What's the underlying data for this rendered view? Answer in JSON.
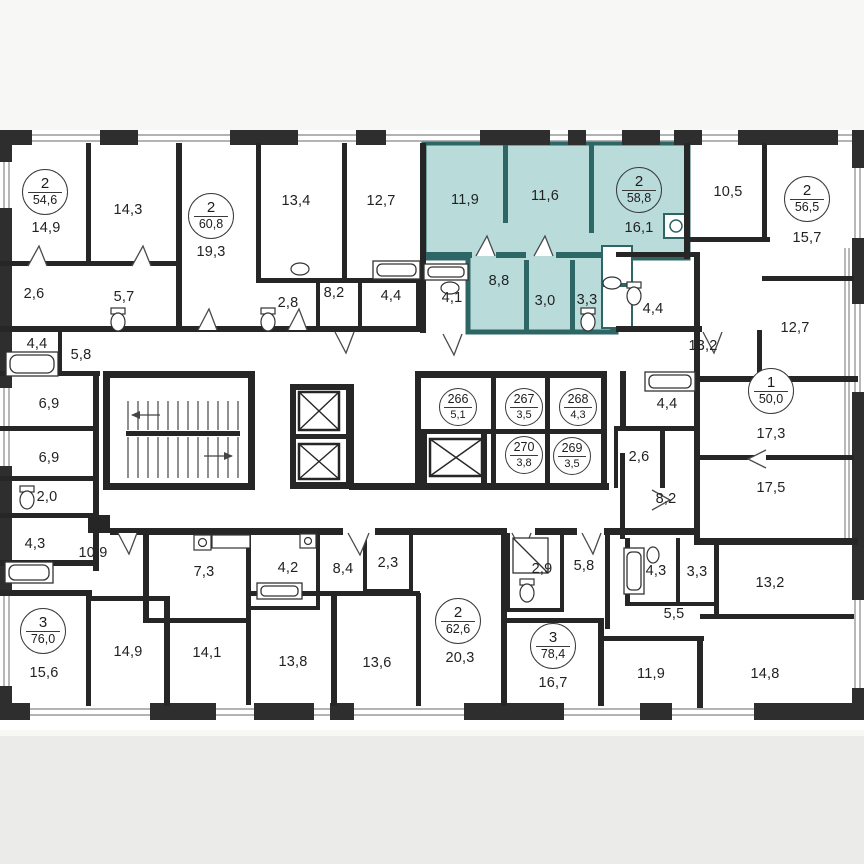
{
  "plan": {
    "type": "residential-floor-plan",
    "wall_color": "#262626",
    "highlight_color": "#b9dcda",
    "highlight_wall_color": "#2d6665",
    "highlighted_apartment": {
      "num": "2",
      "area": "58,8"
    },
    "apartments": [
      {
        "num": "2",
        "area": "54,6"
      },
      {
        "num": "2",
        "area": "60,8"
      },
      {
        "num": "2",
        "area": "58,8"
      },
      {
        "num": "2",
        "area": "56,5"
      },
      {
        "num": "1",
        "area": "50,0"
      },
      {
        "num": "3",
        "area": "76,0"
      },
      {
        "num": "2",
        "area": "62,6"
      },
      {
        "num": "3",
        "area": "78,4"
      }
    ],
    "units": [
      {
        "num": "266",
        "area": "5,1"
      },
      {
        "num": "267",
        "area": "3,5"
      },
      {
        "num": "268",
        "area": "4,3"
      },
      {
        "num": "270",
        "area": "3,8"
      },
      {
        "num": "269",
        "area": "3,5"
      }
    ],
    "rooms": [
      "14,9",
      "14,3",
      "19,3",
      "13,4",
      "12,7",
      "11,9",
      "11,6",
      "16,1",
      "10,5",
      "15,7",
      "2,6",
      "5,7",
      "4,4",
      "5,8",
      "2,8",
      "8,2",
      "4,4",
      "4,1",
      "8,8",
      "3,0",
      "3,3",
      "4,4",
      "13,2",
      "12,7",
      "6,9",
      "6,9",
      "2,0",
      "4,3",
      "10,9",
      "4,4",
      "17,3",
      "2,6",
      "17,5",
      "8,2",
      "7,3",
      "4,2",
      "8,4",
      "2,3",
      "2,9",
      "5,8",
      "4,3",
      "3,3",
      "13,2",
      "5,5",
      "15,6",
      "14,9",
      "14,1",
      "13,8",
      "13,6",
      "20,3",
      "16,7",
      "11,9",
      "14,8"
    ],
    "fixture_icons": [
      "bathtub",
      "toilet",
      "sink",
      "shower",
      "washing-machine",
      "elevator",
      "stairs"
    ]
  }
}
